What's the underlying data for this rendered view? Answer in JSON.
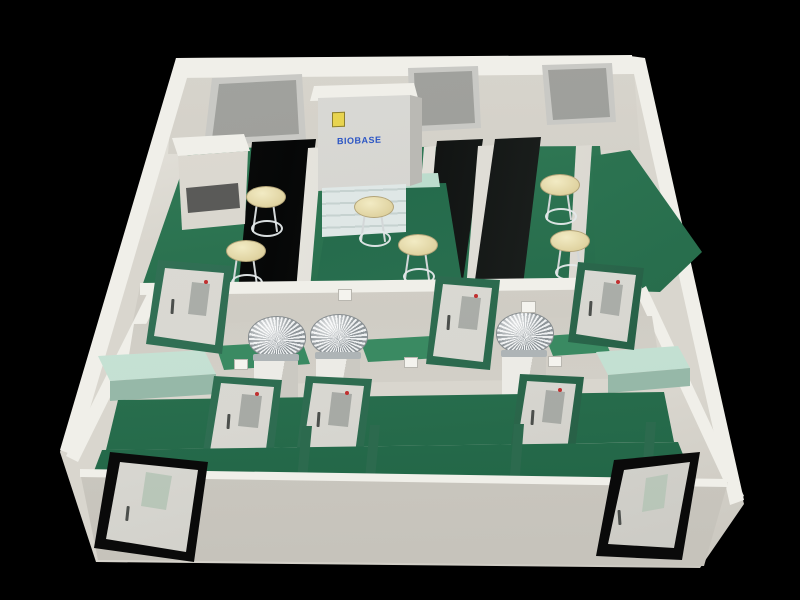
{
  "scene": {
    "description": "3D cutaway rendering of a laboratory floor plan on a black background",
    "cabinet": {
      "brand_label": "BIOBASE"
    },
    "inventory": {
      "frosted_windows": 3,
      "black_lab_benches": 3,
      "lab_stools": 6,
      "dome_equipment_units": 3,
      "green_frame_doors": 6,
      "black_frame_doors": 2,
      "mint_counters": 2,
      "center_island_tables": 1,
      "equipment_tables": 1
    }
  },
  "palette": {
    "bg": "#000000",
    "wall": "#d9d6ce",
    "wall_light": "#f0efe9",
    "wall_dark": "#c6c3bb",
    "floor_a": "#39855e",
    "floor_b": "#1d5f42",
    "mint": "#bcdccd",
    "mint_dark": "#96b8a8",
    "bench": "#0b0d0c",
    "door_face": "#d8d7d1",
    "frame_green": "#2c6a4e",
    "frame_black": "#0a0a0a",
    "glass": "#9a9b97",
    "win_frame": "#c9c9c5",
    "chrome_a": "#eef0f1",
    "chrome_b": "#8f969a",
    "stool_a": "#f2ebc4",
    "stool_b": "#d8c992",
    "label_blue": "#2b55c4",
    "sticker": "#e8d44f",
    "red_dot": "#c03030"
  }
}
